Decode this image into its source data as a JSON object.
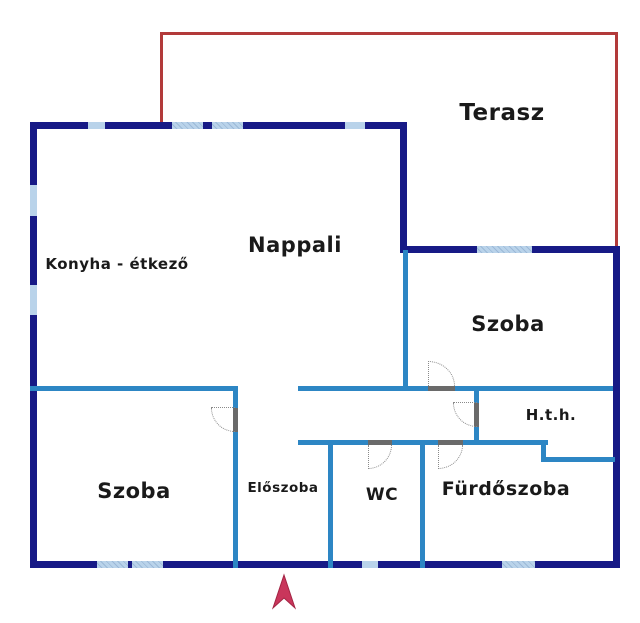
{
  "rooms": [
    {
      "id": "terasz",
      "label": "Terasz"
    },
    {
      "id": "nappali",
      "label": "Nappali"
    },
    {
      "id": "konyha",
      "label": "Konyha - étkező"
    },
    {
      "id": "szoba-top",
      "label": "Szoba"
    },
    {
      "id": "hth",
      "label": "H.t.h."
    },
    {
      "id": "furdoszoba",
      "label": "Fürdőszoba"
    },
    {
      "id": "wc",
      "label": "WC"
    },
    {
      "id": "eloszoba",
      "label": "Előszoba"
    },
    {
      "id": "szoba-bottom",
      "label": "Szoba"
    }
  ],
  "colors": {
    "background": "#ffffff",
    "wall-exterior": "#171a86",
    "wall-interior": "#2d86c4",
    "window": "#b9d3ea",
    "window-hatch": "#9cb9d8",
    "terrace-line": "#b23a3a",
    "door": "#6a6a6a",
    "door-arc": "#8a8a8a",
    "arrow": "#c9365b",
    "label": "#1a1a1a"
  }
}
